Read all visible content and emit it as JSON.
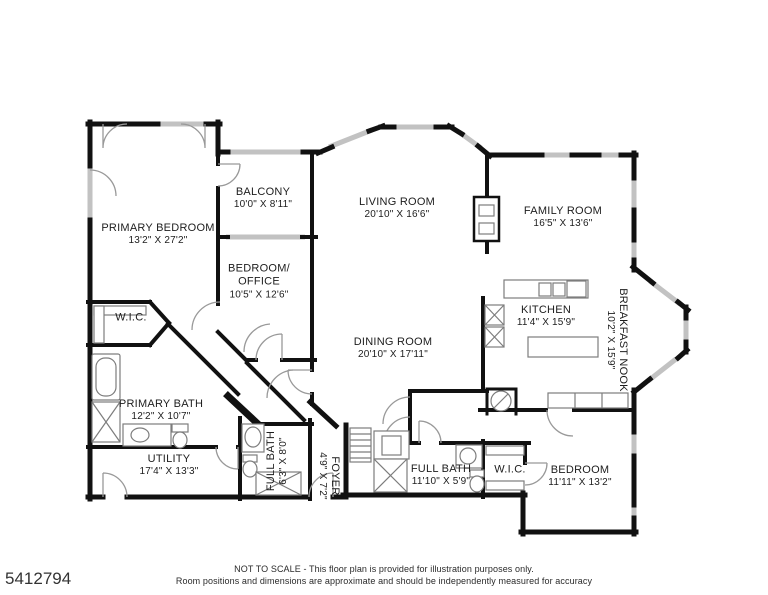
{
  "plan": {
    "colors": {
      "wall": "#111111",
      "window": "#c2c2c2",
      "fixture": "#7d7d7d"
    },
    "rooms": [
      {
        "id": "primary-bedroom",
        "name": "PRIMARY BEDROOM",
        "dims": "13'2\" X 27'2\""
      },
      {
        "id": "balcony",
        "name": "BALCONY",
        "dims": "10'0\" X 8'11\""
      },
      {
        "id": "bedroom-office",
        "name": "BEDROOM/\nOFFICE",
        "dims": "10'5\" X 12'6\""
      },
      {
        "id": "living-room",
        "name": "LIVING ROOM",
        "dims": "20'10\" X 16'6\""
      },
      {
        "id": "family-room",
        "name": "FAMILY ROOM",
        "dims": "16'5\" X 13'6\""
      },
      {
        "id": "kitchen",
        "name": "KITCHEN",
        "dims": "11'4\" X 15'9\""
      },
      {
        "id": "breakfast-nook",
        "name": "BREAKFAST NOOK",
        "dims": "10'2\" X 15'9\""
      },
      {
        "id": "dining-room",
        "name": "DINING ROOM",
        "dims": "20'10\" X 17'11\""
      },
      {
        "id": "wic-primary",
        "name": "W.I.C.",
        "dims": ""
      },
      {
        "id": "primary-bath",
        "name": "PRIMARY BATH",
        "dims": "12'2\" X 10'7\""
      },
      {
        "id": "utility",
        "name": "UTILITY",
        "dims": "17'4\" X 13'3\""
      },
      {
        "id": "full-bath-small",
        "name": "FULL BATH",
        "dims": "6'3\" X 8'0\""
      },
      {
        "id": "foyer",
        "name": "FOYER",
        "dims": "4'9\" X 7'2\""
      },
      {
        "id": "full-bath",
        "name": "FULL BATH",
        "dims": "11'10\" X 5'9\""
      },
      {
        "id": "wic-bedroom",
        "name": "W.I.C.",
        "dims": ""
      },
      {
        "id": "bedroom",
        "name": "BEDROOM",
        "dims": "11'11\" X 13'2\""
      }
    ]
  },
  "footer": {
    "listing_id": "5412794",
    "disclaimer_line1": "NOT TO SCALE - This floor plan is provided for illustration purposes only.",
    "disclaimer_line2": "Room positions and dimensions are approximate and should be independently measured for accuracy"
  }
}
